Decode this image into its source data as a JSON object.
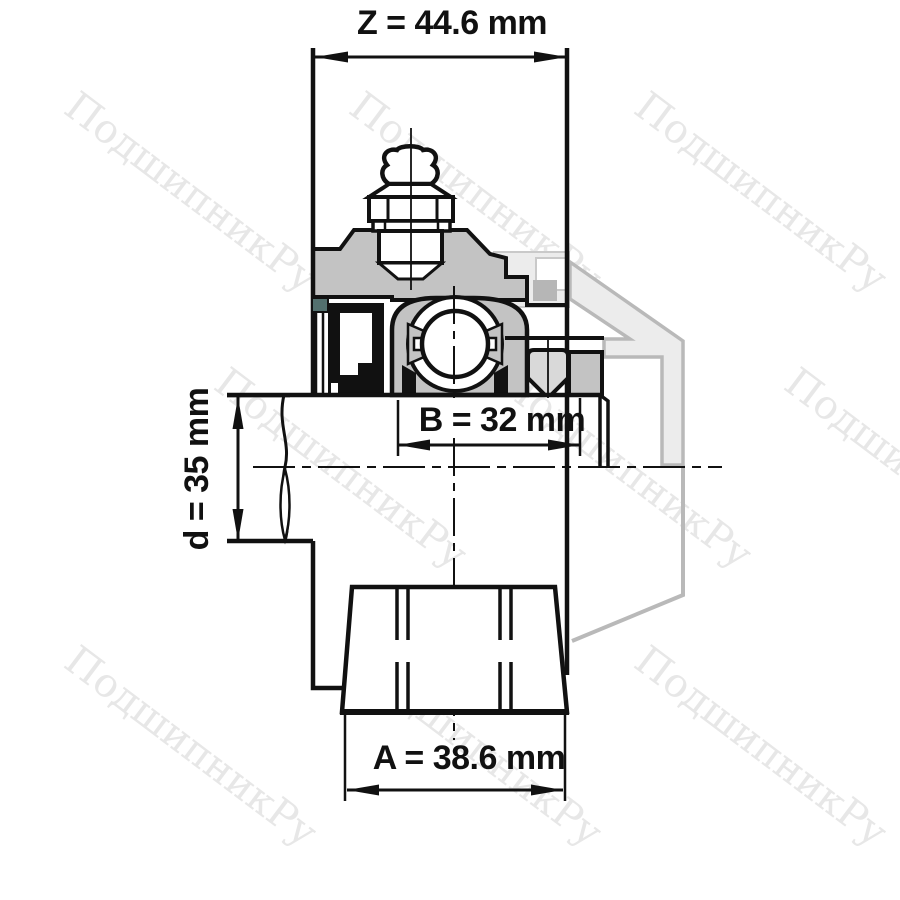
{
  "watermark": {
    "text": "ПодшипникРу",
    "color": "#e7e7e7"
  },
  "dimensions": {
    "z": {
      "name": "Z",
      "label": "Z = 44.6 mm",
      "value": 44.6,
      "unit": "mm"
    },
    "b": {
      "name": "B",
      "label": "B = 32 mm",
      "value": 32,
      "unit": "mm"
    },
    "d": {
      "name": "d",
      "label": "d = 35 mm",
      "value": 35,
      "unit": "mm"
    },
    "a": {
      "name": "A",
      "label": "A = 38.6 mm",
      "value": 38.6,
      "unit": "mm"
    }
  },
  "colors": {
    "background": "#ffffff",
    "line": "#111111",
    "housing_fill": "#c3c3c3",
    "screw_fill": "#d9d9d9",
    "seal_fill": "#111111",
    "slinger_accent": "#53706e",
    "ghost_fill": "#ececec",
    "ghost_stroke": "#b9b9b9",
    "ghost_inner_fill": "#b6b6b6",
    "watermark_color": "#e7e7e7"
  }
}
